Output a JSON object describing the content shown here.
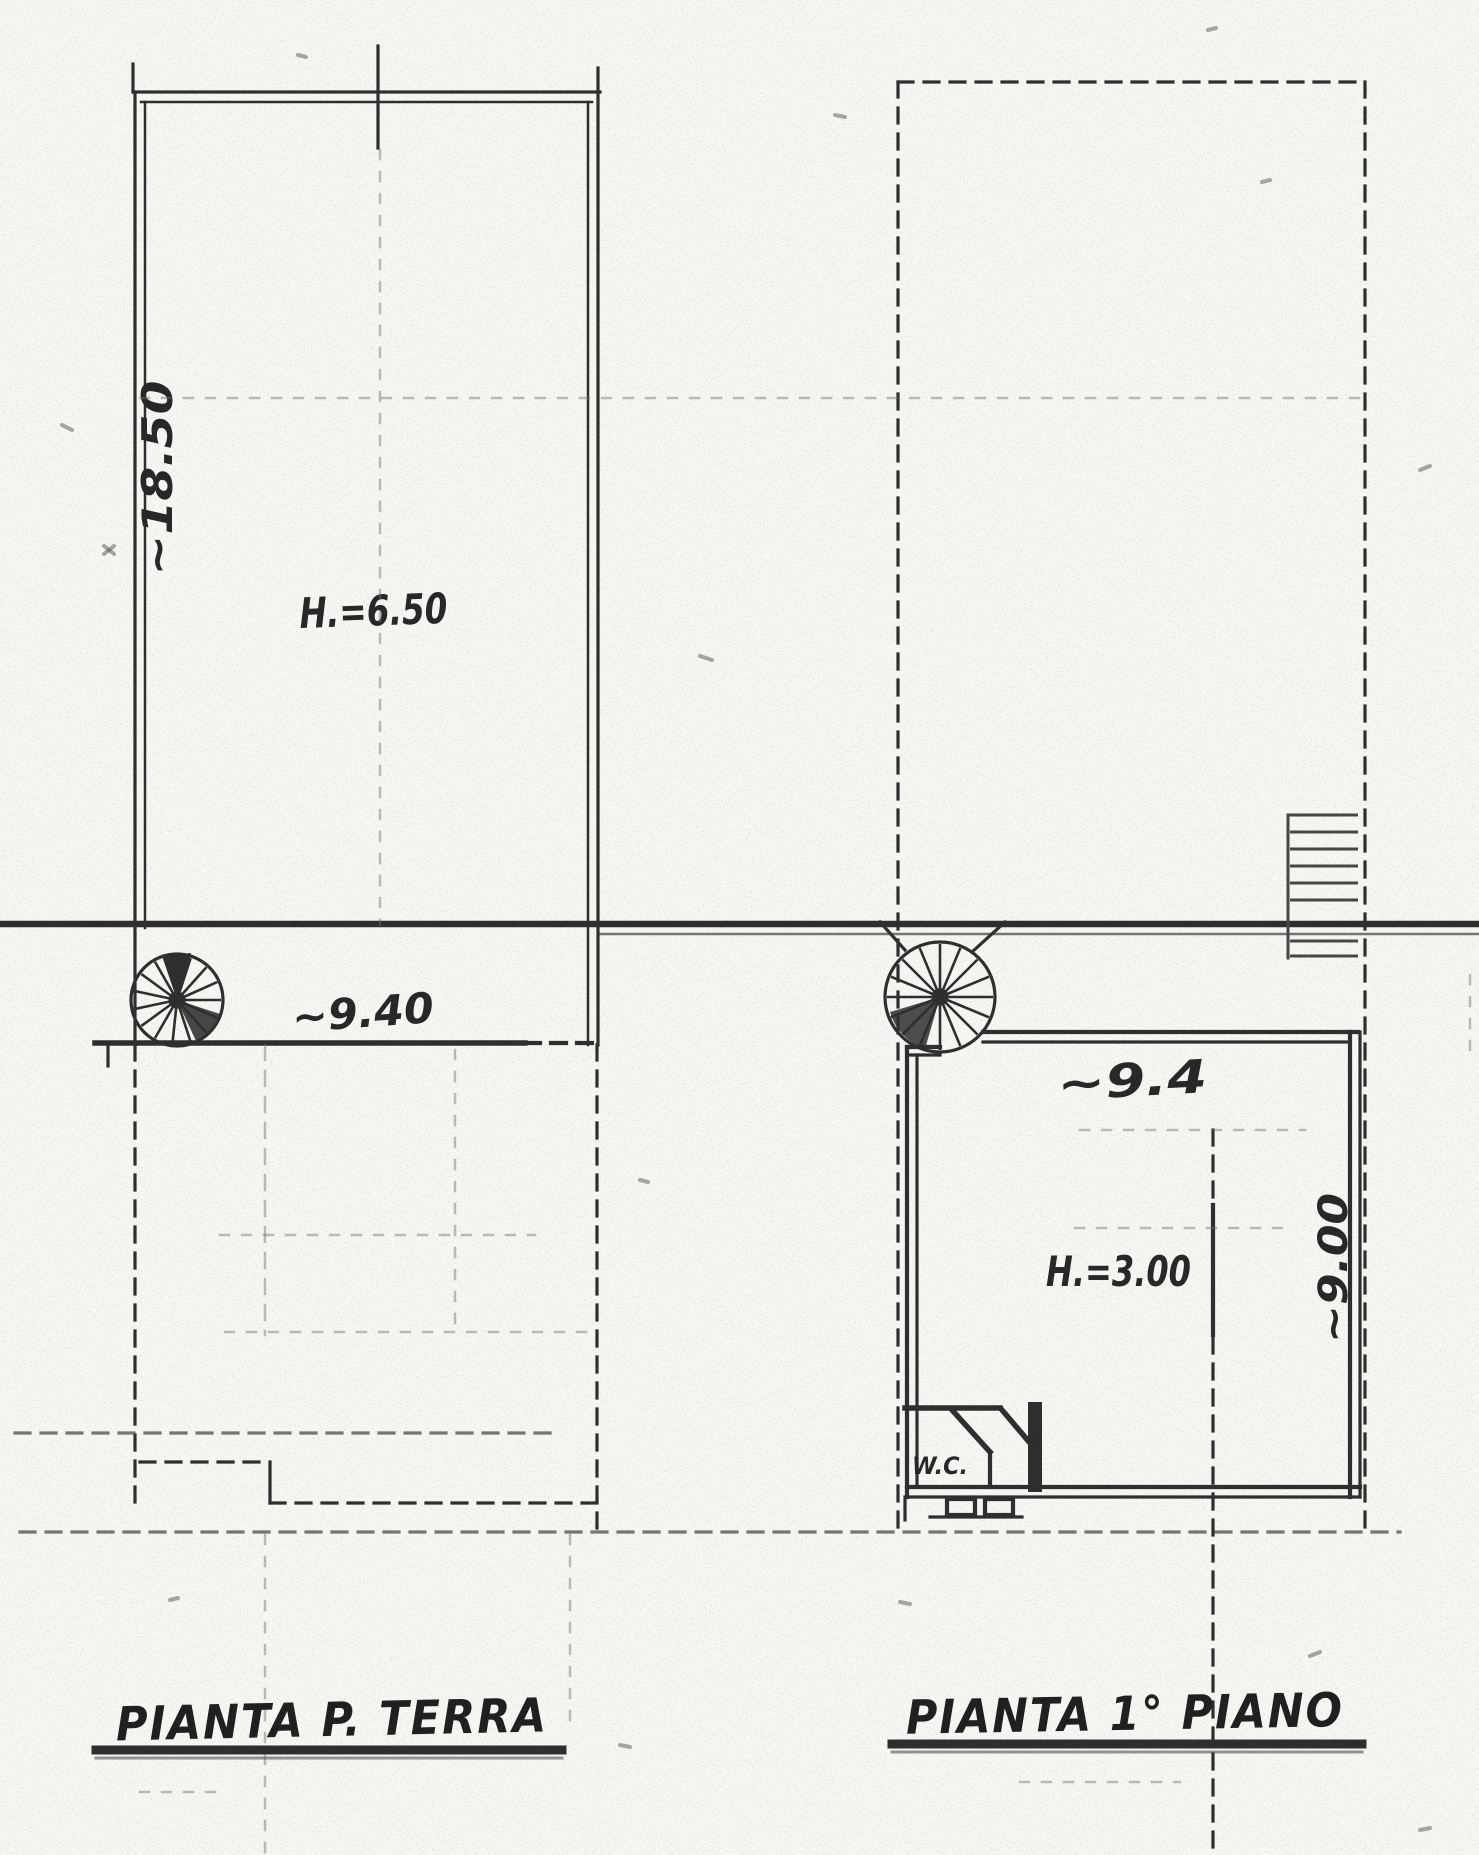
{
  "palette": {
    "paper": "#f8f7f4",
    "ink": "#2d2d2d",
    "ink_faint": "#6e6e6e"
  },
  "ground_floor_plan": {
    "title": "PIANTA P. TERRA",
    "room_height_label": "H.=6.50",
    "width_dimension": "~9.40",
    "depth_dimension": "~18.50"
  },
  "first_floor_plan": {
    "title": "PIANTA 1° PIANO",
    "room_height_label": "H.=3.00",
    "width_dimension": "~9.4",
    "depth_dimension": "~9.00",
    "wc_label": "W.C."
  }
}
